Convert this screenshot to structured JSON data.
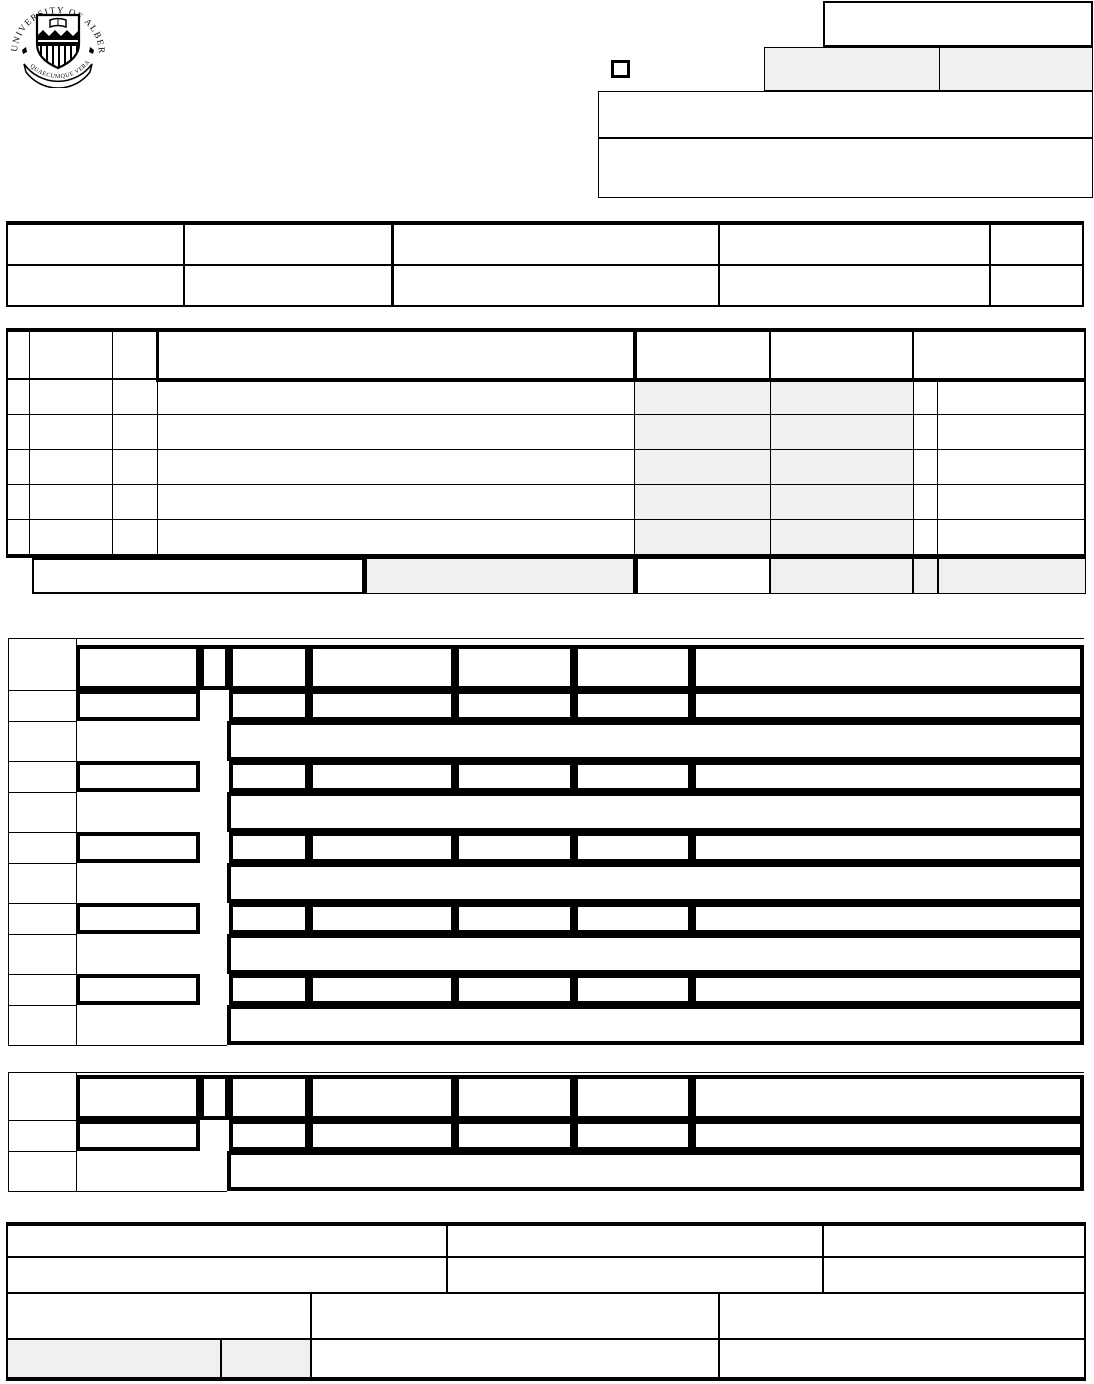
{
  "page": {
    "background": "#ffffff",
    "line_color": "#000000",
    "shaded_color": "#f0f0f0"
  },
  "logo": {
    "arc_text": "UNIVERSITY OF ALBERTA",
    "motto_text": "QUAECUMQUE VERA"
  },
  "top_right_panel": {
    "small_top_box_value": "",
    "left_shaded_box_value": "",
    "right_shaded_box_value": "",
    "wide_box_1_value": "",
    "wide_box_2_value": "",
    "checkbox_checked": false
  },
  "info_table": {
    "row_count": 2,
    "column_count": 5,
    "cells": [
      [
        "",
        "",
        "",
        "",
        ""
      ],
      [
        "",
        "",
        "",
        "",
        ""
      ]
    ]
  },
  "detail_table": {
    "header_cells": [
      "",
      "",
      "",
      "",
      "",
      "",
      ""
    ],
    "data_row_count": 5,
    "data_rows": [
      [
        "",
        "",
        "",
        "",
        "",
        "",
        "",
        ""
      ],
      [
        "",
        "",
        "",
        "",
        "",
        "",
        "",
        ""
      ],
      [
        "",
        "",
        "",
        "",
        "",
        "",
        "",
        ""
      ],
      [
        "",
        "",
        "",
        "",
        "",
        "",
        "",
        ""
      ],
      [
        "",
        "",
        "",
        "",
        "",
        "",
        "",
        ""
      ]
    ],
    "shaded_data_columns": [
      4,
      5
    ],
    "footer_cells": [
      "",
      "",
      "",
      "",
      "",
      ""
    ]
  },
  "entry_grid_large": {
    "entry_count": 5,
    "header_cells": [
      "",
      "",
      "",
      "",
      "",
      "",
      ""
    ],
    "entries": [
      {
        "fields": [
          "",
          "",
          "",
          "",
          "",
          ""
        ],
        "description": ""
      },
      {
        "fields": [
          "",
          "",
          "",
          "",
          "",
          ""
        ],
        "description": ""
      },
      {
        "fields": [
          "",
          "",
          "",
          "",
          "",
          ""
        ],
        "description": ""
      },
      {
        "fields": [
          "",
          "",
          "",
          "",
          "",
          ""
        ],
        "description": ""
      },
      {
        "fields": [
          "",
          "",
          "",
          "",
          "",
          ""
        ],
        "description": ""
      }
    ]
  },
  "entry_grid_small": {
    "entry_count": 1,
    "header_cells": [
      "",
      "",
      "",
      "",
      "",
      "",
      ""
    ],
    "entries": [
      {
        "fields": [
          "",
          "",
          "",
          "",
          "",
          ""
        ],
        "description": ""
      }
    ]
  },
  "signature_table": {
    "row1_cells": [
      "",
      "",
      ""
    ],
    "row2_cells": [
      "",
      "",
      ""
    ],
    "row3_cells": [
      "",
      "",
      ""
    ],
    "row4_cells": [
      "",
      "",
      "",
      ""
    ],
    "row4_shaded_cells": [
      0,
      1
    ]
  }
}
